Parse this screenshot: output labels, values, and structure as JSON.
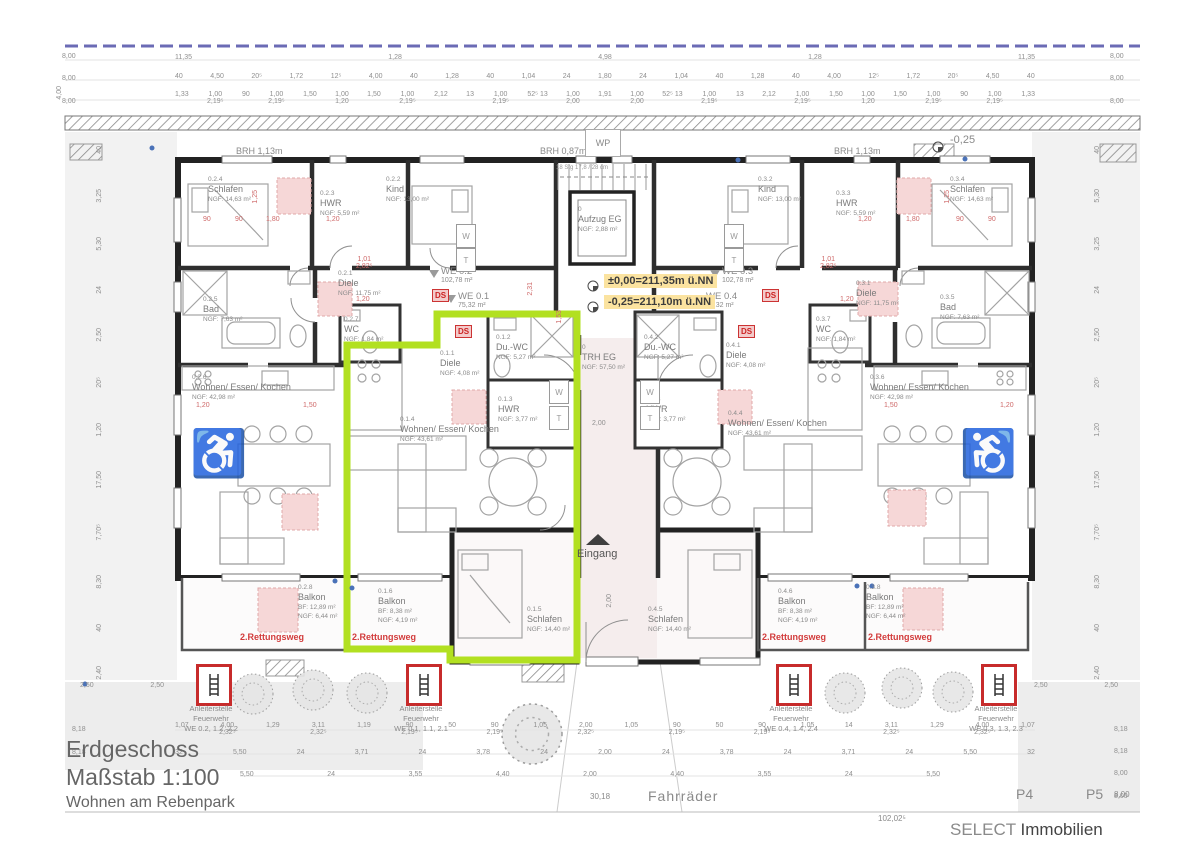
{
  "title_block": {
    "line1": "Erdgeschoss",
    "line2": "Maßstab 1:100",
    "line3": "Wohnen am Rebenpark"
  },
  "brand": {
    "select": "SELECT",
    "immobilien": " Immobilien"
  },
  "annotations": {
    "wp": "WP",
    "eingang": "Eingang",
    "fahrraeder": "Fahrräder",
    "level_zero": "±0,00=211,35m ü.NN",
    "level_minus": "-0,25=211,10m ü.NN",
    "minus_025": "-0,25",
    "brh_left": "BRH 1,13m",
    "brh_center": "BRH 0,87m",
    "brh_right": "BRH 1,13m",
    "rescue": "2.Rettungsweg",
    "ds": "DS",
    "stair_note": "18 Stg 17,8 / 28 cm",
    "p4": "P4",
    "p5": "P5",
    "p5_dim": "8,00",
    "dim_3018": "30,18",
    "dim_total": "102,02⁵",
    "w": "W",
    "t": "T",
    "wheelchair": "♿"
  },
  "apartments": {
    "we02": {
      "name": "WE 0.2",
      "area": "102,78 m²"
    },
    "we01": {
      "name": "WE 0.1",
      "area": "75,32 m²"
    },
    "we03": {
      "name": "WE 0.3",
      "area": "102,78 m²"
    },
    "we04": {
      "name": "WE 0.4",
      "area": "75,32 m²"
    }
  },
  "rooms": {
    "r021": {
      "id": "0.2.1",
      "name": "Diele",
      "area": "NGF: 11,75 m²"
    },
    "r022": {
      "id": "0.2.2",
      "name": "Kind",
      "area": "NGF: 13,00 m²"
    },
    "r023": {
      "id": "0.2.3",
      "name": "HWR",
      "area": "NGF: 5,59 m²"
    },
    "r024": {
      "id": "0.2.4",
      "name": "Schlafen",
      "area": "NGF: 14,63 m²"
    },
    "r025": {
      "id": "0.2.5",
      "name": "Bad",
      "area": "NGF: 7,63 m²"
    },
    "r026": {
      "id": "0.2.6",
      "name": "Wohnen/ Essen/ Kochen",
      "area": "NGF: 42,98 m²"
    },
    "r027": {
      "id": "0.2.7",
      "name": "WC",
      "area": "NGF: 1,84 m²"
    },
    "r028": {
      "id": "0.2.8",
      "name": "Balkon",
      "area": "BF: 12,89 m²",
      "area2": "NGF: 6,44 m²"
    },
    "r011": {
      "id": "0.1.1",
      "name": "Diele",
      "area": "NGF: 4,08 m²"
    },
    "r012": {
      "id": "0.1.2",
      "name": "Du.-WC",
      "area": "NGF: 5,27 m²"
    },
    "r013": {
      "id": "0.1.3",
      "name": "HWR",
      "area": "NGF: 3,77 m²"
    },
    "r014": {
      "id": "0.1.4",
      "name": "Wohnen/ Essen/ Kochen",
      "area": "NGF: 43,61 m²"
    },
    "r015": {
      "id": "0.1.5",
      "name": "Schlafen",
      "area": "NGF: 14,40 m²"
    },
    "r016": {
      "id": "0.1.6",
      "name": "Balkon",
      "area": "BF: 8,38 m²",
      "area2": "NGF: 4,19 m²"
    },
    "r031": {
      "id": "0.3.1",
      "name": "Diele",
      "area": "NGF: 11,75 m²"
    },
    "r032": {
      "id": "0.3.2",
      "name": "Kind",
      "area": "NGF: 13,00 m²"
    },
    "r033": {
      "id": "0.3.3",
      "name": "HWR",
      "area": "NGF: 5,59 m²"
    },
    "r034": {
      "id": "0.3.4",
      "name": "Schlafen",
      "area": "NGF: 14,63 m²"
    },
    "r035": {
      "id": "0.3.5",
      "name": "Bad",
      "area": "NGF: 7,63 m²"
    },
    "r036": {
      "id": "0.3.6",
      "name": "Wohnen/ Essen/ Kochen",
      "area": "NGF: 42,98 m²"
    },
    "r037": {
      "id": "0.3.7",
      "name": "WC",
      "area": "NGF: 1,84 m²"
    },
    "r038": {
      "id": "0.3.8",
      "name": "Balkon",
      "area": "BF: 12,89 m²",
      "area2": "NGF: 6,44 m²"
    },
    "r041": {
      "id": "0.4.1",
      "name": "Diele",
      "area": "NGF: 4,08 m²"
    },
    "r042": {
      "id": "0.4.2",
      "name": "Du.-WC",
      "area": "NGF: 5,27 m²"
    },
    "r043": {
      "id": "0.4.3",
      "name": "HWR",
      "area": "NGF: 3,77 m²"
    },
    "r044": {
      "id": "0.4.4",
      "name": "Wohnen/ Essen/ Kochen",
      "area": "NGF: 43,61 m²"
    },
    "r045": {
      "id": "0.4.5",
      "name": "Schlafen",
      "area": "NGF: 14,40 m²"
    },
    "r046": {
      "id": "0.4.6",
      "name": "Balkon",
      "area": "BF: 8,38 m²",
      "area2": "NGF: 4,19 m²"
    },
    "aufzug": {
      "id": "0",
      "name": "Aufzug EG",
      "area": "NGF: 2,88 m²"
    },
    "trh": {
      "id": "0",
      "name": "TRH EG",
      "area": "NGF: 57,50 m²"
    }
  },
  "ladders": [
    {
      "l1": "Anleiterstelle",
      "l2": "Feuerwehr",
      "l3": "WE 0.2, 1.2, 2.2"
    },
    {
      "l1": "Anleiterstelle",
      "l2": "Feuerwehr",
      "l3": "WE 0.1, 1.1, 2.1"
    },
    {
      "l1": "Anleiterstelle",
      "l2": "Feuerwehr",
      "l3": "WE 0.4, 1.4, 2.4"
    },
    {
      "l1": "Anleiterstelle",
      "l2": "Feuerwehr",
      "l3": "WE 0.3, 1.3, 2.3"
    }
  ],
  "dims": {
    "top1": [
      "11,35",
      "1,28",
      "4,98",
      "1,28",
      "11,35"
    ],
    "top2": [
      "40",
      "4,50",
      "20⁵",
      "1,72",
      "12⁵",
      "4,00",
      "40",
      "1,28",
      "40",
      "1,04",
      "24",
      "1,80",
      "24",
      "1,04",
      "40",
      "1,28",
      "40",
      "4,00",
      "12⁵",
      "1,72",
      "20⁵",
      "4,50",
      "40"
    ],
    "top3": [
      "1,33",
      "1,00|2,19⁵",
      "90",
      "1,00|2,19⁵",
      "1,50",
      "1,00|1,20",
      "1,50",
      "1,00|2,19⁵",
      "2,12",
      "13",
      "1,00|2,19⁵",
      "52⁵ 13",
      "1,00|2,00",
      "1,91",
      "1,00|2,00",
      "52⁵ 13",
      "1,00|2,19⁵",
      "13",
      "2,12",
      "1,00|2,19⁵",
      "1,50",
      "1,00|1,20",
      "1,50",
      "1,00|2,19⁵",
      "90",
      "1,00|2,19⁵",
      "1,33"
    ],
    "left_edge": [
      "8,00",
      "8,00",
      "8,00"
    ],
    "right_edge": [
      "8,00",
      "8,00",
      "8,00"
    ],
    "left_col": [
      "40",
      "3,25",
      "5,30",
      "24",
      "2,50",
      "20⁵",
      "1,20",
      "17,50",
      "7,70⁵",
      "8,30",
      "40",
      "2,40"
    ],
    "right_col": [
      "40",
      "5,30",
      "3,25",
      "24",
      "2,50",
      "20⁵",
      "1,20",
      "17,50",
      "7,70⁵",
      "8,30",
      "40",
      "2,40"
    ],
    "bottom1": [
      "1,07",
      "4,00|2,32⁵",
      "1,29",
      "3,11|2,32⁵",
      "1,19",
      "90|2,19⁵",
      "50",
      "90|2,19⁵",
      "1,05",
      "2,00|2,32⁵",
      "1,05",
      "90|2,19⁵",
      "50",
      "90|2,19⁵",
      "1,05",
      "14",
      "3,11|2,32⁵",
      "1,29",
      "4,00|2,32⁵",
      "1,07"
    ],
    "bottom2": [
      "32",
      "5,50",
      "24",
      "3,71",
      "24",
      "3,78",
      "24",
      "2,00",
      "24",
      "3,78",
      "24",
      "3,71",
      "24",
      "5,50",
      "32"
    ],
    "bottom3": [
      "5,50",
      "24",
      "3,55",
      "4,40",
      "2,00",
      "4,40",
      "3,55",
      "24",
      "5,50"
    ],
    "corner_left": [
      "2,50",
      "2,50"
    ],
    "corner_right": [
      "2,50",
      "2,50"
    ],
    "left_block": [
      "8,18",
      "8,18"
    ],
    "right_block": [
      "8,18",
      "8,18",
      "8,00",
      "8,00"
    ],
    "floating": [
      "90",
      "90",
      "1,80",
      "1,20",
      "1,20",
      "1,80",
      "90",
      "90",
      "1,20",
      "1,50",
      "1,50",
      "1,20",
      "1,20",
      "1,20",
      "1,01|2,82⁵",
      "1,01|2,82⁵",
      "2,00",
      "2,31",
      "1,53",
      "1,25",
      "1,25",
      "2,00",
      "40",
      "40",
      "4,00"
    ]
  }
}
